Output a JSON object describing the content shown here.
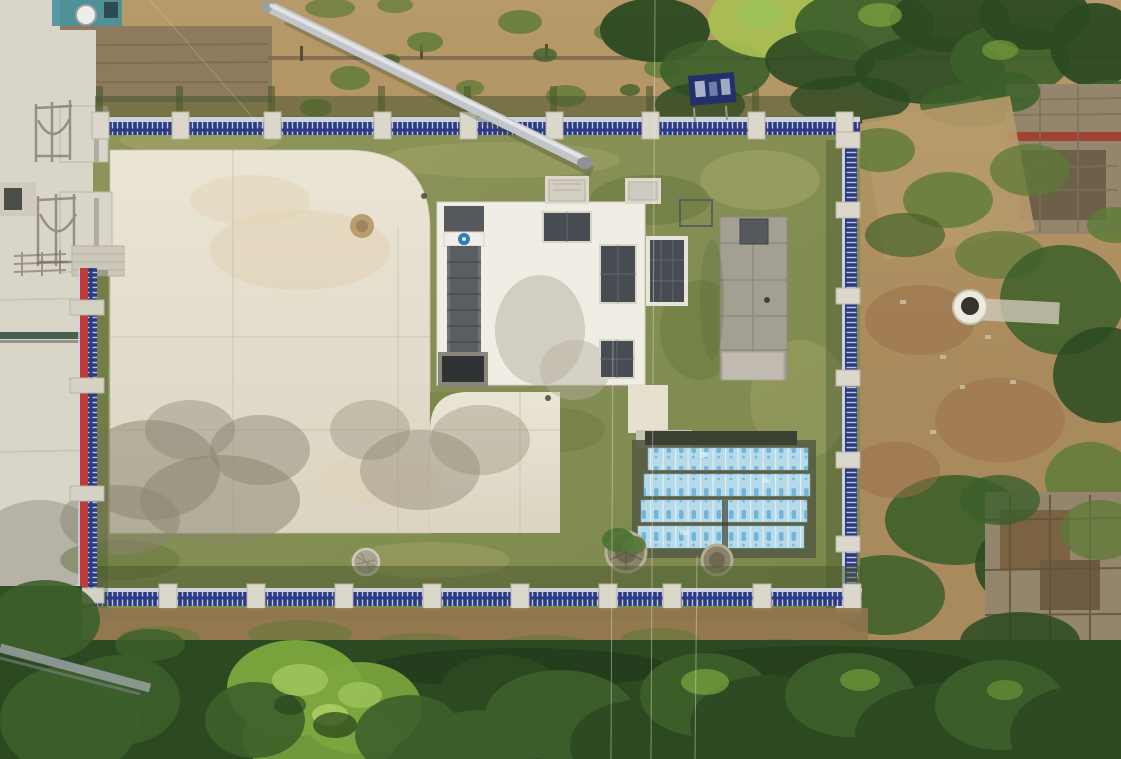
{
  "image": {
    "kind": "aerial-drone-photo",
    "subject": "top-down view of a small fenced water/sewage treatment compound surrounded by bare soil, scrub and trees",
    "width_px": 1121,
    "height_px": 759
  },
  "features": {
    "compound": "rectangular yard with olive lawn and large light concrete pad",
    "perimeter_fence": {
      "style": "blue steel picket fence with concrete posts",
      "west_section_colors": [
        "red",
        "navy blue"
      ],
      "post_counts": {
        "north": 9,
        "east": 7,
        "south": 10,
        "west": 4
      }
    },
    "structures": [
      {
        "name": "main-equipment-building",
        "desc": "white flat roof, dark skylight panels, grey screw-conveyor channel with blue logo disc"
      },
      {
        "name": "secondary-building",
        "desc": "grey panelled roof with dark rooftop unit and light platform"
      },
      {
        "name": "membrane-tank-array",
        "rows": 4,
        "desc": "modules wrapped in light-blue protective film with logo print"
      },
      {
        "name": "steel-pipe-chute",
        "desc": "silver pipe running diagonally down the north slope"
      },
      {
        "name": "well-head",
        "desc": "white concrete ring with dark opening, east of fence"
      },
      {
        "name": "ruin-upper",
        "desc": "stone shed remains, north-east"
      },
      {
        "name": "ruin-lower",
        "desc": "collapsed brick structure, south-east"
      }
    ],
    "ground_covers": [
      "masonry planter rings",
      "round manhole covers",
      "semicircular white channel cover",
      "round dirt patch on pad"
    ],
    "vegetation": [
      "dense tree canopy along bottom",
      "tree belt along top-right",
      "scrub patches on slopes"
    ],
    "shadows": [
      "ornate entrance-gate shadows on west paving",
      "tree-canopy shadows on concrete pad",
      "fence shadows cast northward"
    ]
  },
  "colors": {
    "dirt_base": "#a98a5c",
    "dirt_light": "#b79a6a",
    "dirt_red": "#9a6d48",
    "dirt_strip": "#8f744e",
    "wall_stone": "#8e7b5f",
    "slope_line": "#7a6748",
    "pave_outer": "#d9d5c9",
    "pave_step": "#ccc7ba",
    "teal_pool": "#3e8fa0",
    "tank_white": "#eceee8",
    "lawn1": "#8f955a",
    "lawn2": "#7a884c",
    "lawn_dry": "#a7a76b",
    "lawn_dark": "#64743c",
    "shade_olive": "#47552c",
    "pad1": "#ebe5d5",
    "pad2": "#dbd4c1",
    "pad_joint": "#c6c0ae",
    "pad_stain": "#e0d0ae",
    "pad_shadow": "#8a8370",
    "roof_white": "#f0ede5",
    "panel_dark": "#474c52",
    "channel_grey": "#5a5e63",
    "pit_dark": "#2f3336",
    "frame_light": "#d8d4c8",
    "roof_grey1": "#a49f93",
    "roof_grey2": "#8a8579",
    "unit_dark": "#55595d",
    "platform_grey": "#c0bbae",
    "fence_blue": "#2c3a84",
    "fence_rail": "#ccd3df",
    "fence_red": "#bf3a3a",
    "fence_navy": "#2c3570",
    "post": "#dbd7ca",
    "post_edge": "#b8b3a5",
    "film_bg": "#b5dae9",
    "film_edge": "#e6f2f7",
    "film_logo": "#69aed2",
    "array_base": "#565c44",
    "array_dark": "#3c4134",
    "tree_dark": "#2c4a22",
    "tree_mid": "#3c5f2a",
    "tree_bright": "#7ca73e",
    "tree_highlight": "#9cc45a",
    "tree_yellow": "#a9bd52",
    "scrub": "#5d7a36",
    "scrub_dark": "#44622a",
    "ruin_stone": "#93866d",
    "ruin_red": "#a23c2e",
    "ruin_dark": "#6d6049",
    "rubble": "#7a6243",
    "well_white": "#edeade",
    "well_dark": "#35332c",
    "ring_stone": "#8a8269",
    "ring_light": "#b9b09a",
    "ring_inner": "#6e6753",
    "pipe_steel": "#c2c5c9",
    "pipe_hi": "#e8eaec",
    "chute_shadow": "#3f4a28",
    "sign_blue": "#23306b",
    "wire": "#e8e8e0",
    "log_grey": "#9aa0a2",
    "blue_logo": "#2e7cb4"
  }
}
